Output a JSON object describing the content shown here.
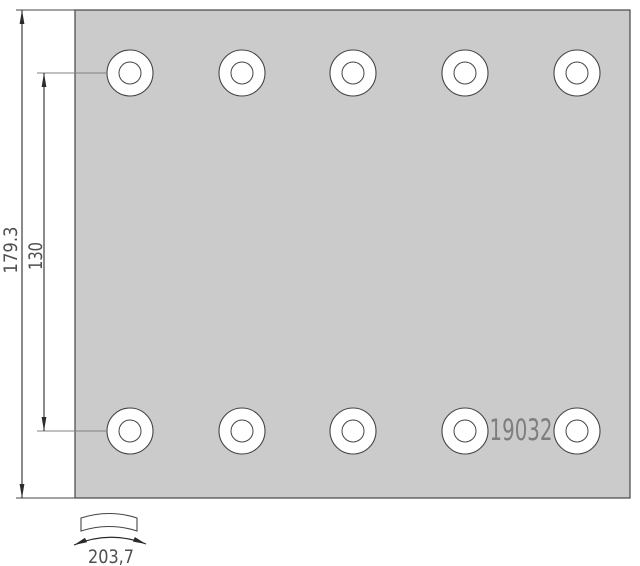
{
  "drawing": {
    "part_number": "19032",
    "dimension_labels": {
      "overall_height": "179.3",
      "rivet_row_spacing": "130",
      "arc_width": "203,7"
    }
  },
  "geometry": {
    "holes": {
      "rows": 2,
      "per_row": 5,
      "rows_y": [
        73,
        431
      ],
      "cols_x": [
        130,
        242,
        353,
        465,
        577
      ],
      "outer_r": 23,
      "inner_r": 11
    }
  },
  "colors": {
    "background": "#ffffff",
    "plate_fill": "#cbcbcb",
    "outline": "#454545",
    "dim_line": "#2b2b2b",
    "ext_line": "#828282",
    "dim_text": "#4f4f4f",
    "part_text": "#7e7e7e"
  }
}
